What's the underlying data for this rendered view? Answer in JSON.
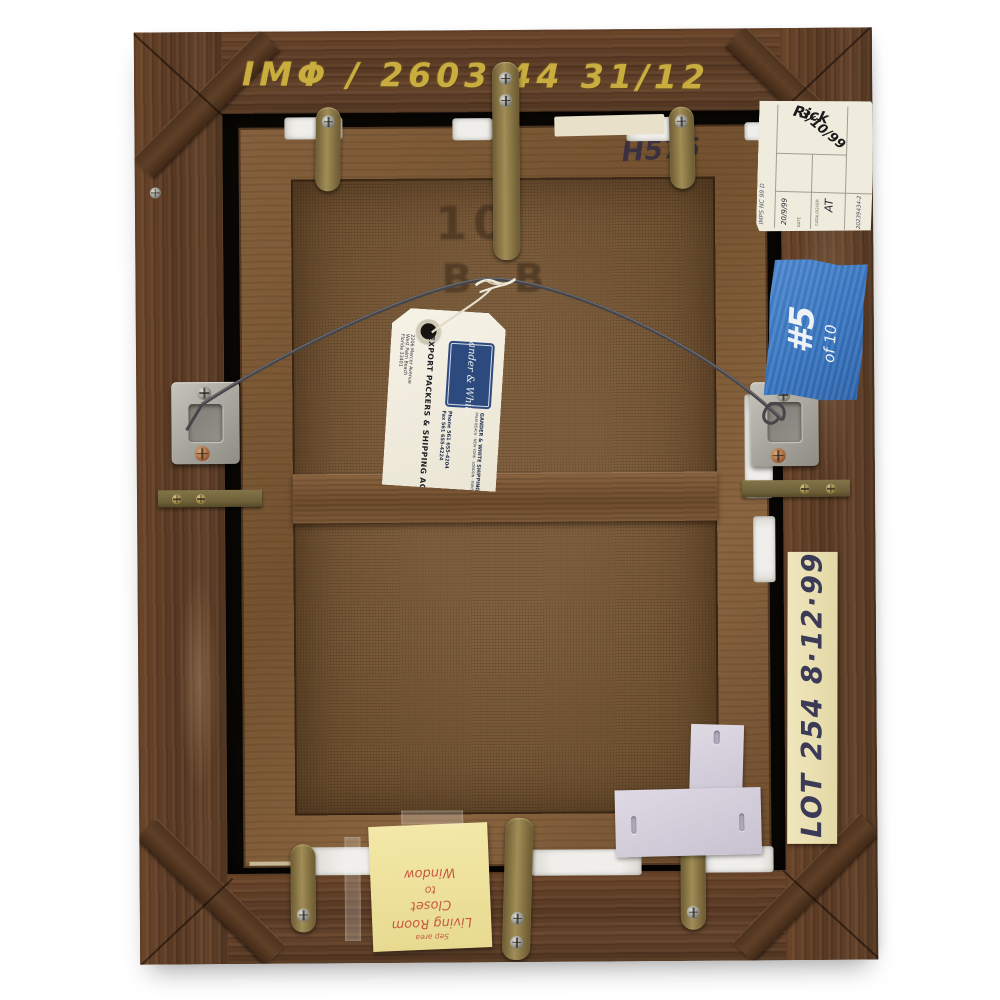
{
  "photo_subject": "Back of a framed painting with auction and shipping labels",
  "frame": {
    "chalk_inscription": "IMΦ / 2603  44  31/12",
    "stretcher_code": "H575",
    "canvas_stencil_line1": "10",
    "canvas_stencil_line2": "B B"
  },
  "catalog_label": {
    "edge_left": "IMPS NC 99 D",
    "name": "Rick",
    "date_big": "3/10/99",
    "date_label": "DATE",
    "date_value": "20/9/99",
    "cataloguer_label": "CATALOGUER",
    "cataloguer_value": "AT",
    "edge_right": "20239434-2"
  },
  "blue_tape": {
    "number": "#5",
    "of_total": "of 10"
  },
  "lot_tape": {
    "text": "LOT 254 8·12·99"
  },
  "shipping_tag": {
    "logo_script": "Gander & White",
    "company": "GANDER & WHITE SHIPPING INC.",
    "cities": "PALM BEACH · NEW YORK · LONDON · PARIS",
    "headline": "EXPORT PACKERS & SHIPPING AGENTS",
    "address1": "2206 Mercer Avenue",
    "address2": "West Palm Beach",
    "address3": "Florida 33401",
    "phone": "Phone 561 655-4204",
    "fax": "Fax 561 655-4224"
  },
  "sticky_note": {
    "line1": "Sep area",
    "line2": "Living Room",
    "line3": "Closet",
    "line4": "to",
    "line5": "Window"
  },
  "colors": {
    "background": "#ffffff",
    "frame_wood": "#5d3d26",
    "stretcher_wood": "#7d5737",
    "canvas_linen": "#7a5c3d",
    "blue_tape": "#3d7cc8",
    "brass": "#8f7d48",
    "sticky_note": "#efe3a0",
    "lot_tape": "#e9dfb4",
    "tag_logo_navy": "#2d4a7e",
    "chalk_yellow": "#c9ad3e"
  }
}
